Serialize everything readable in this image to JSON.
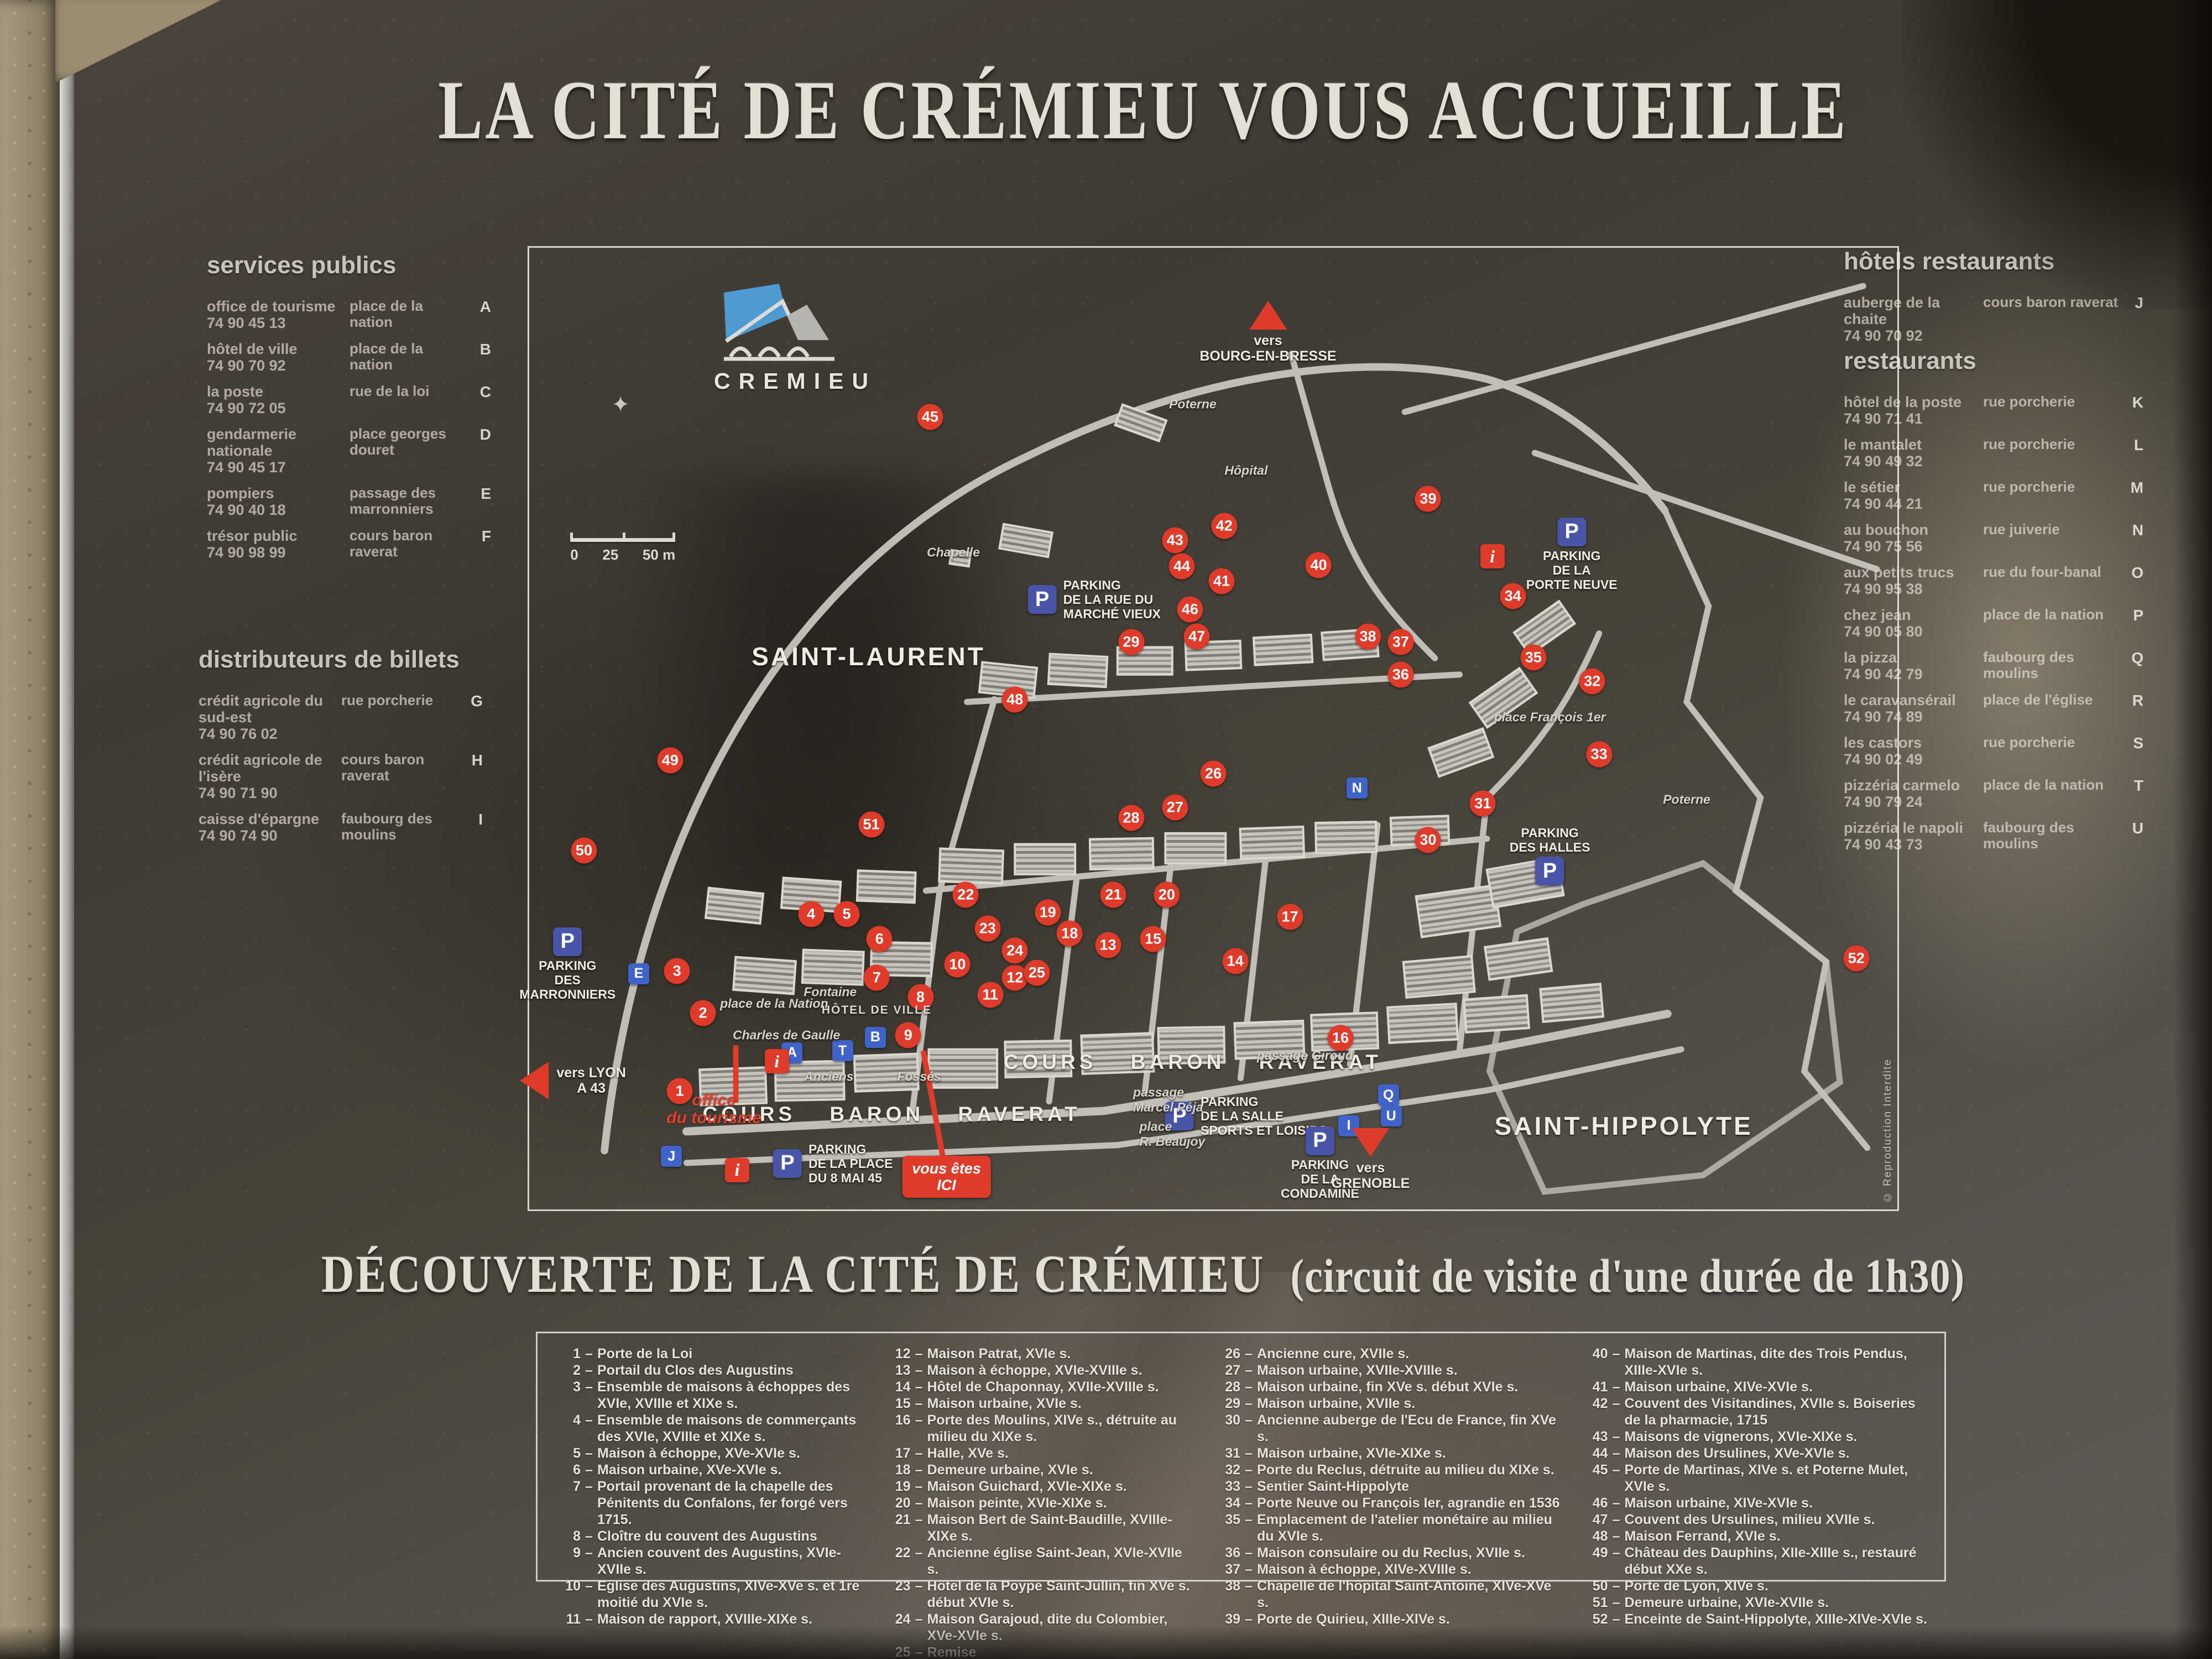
{
  "board": {
    "title": "LA CITÉ DE CRÉMIEU VOUS ACCUEILLE",
    "colors": {
      "accent_red": "#df3b2a",
      "parking_blue": "#4a55a8",
      "letter_blue": "#3f63c8",
      "logo_blue": "#4e9bd4"
    }
  },
  "services_publics": {
    "heading": "services publics",
    "entries": [
      {
        "name": "office de tourisme",
        "phone": "74 90 45 13",
        "location": "place de la nation",
        "letter": "A"
      },
      {
        "name": "hôtel de ville",
        "phone": "74 90 70 92",
        "location": "place de la nation",
        "letter": "B"
      },
      {
        "name": "la poste",
        "phone": "74 90 72 05",
        "location": "rue de la loi",
        "letter": "C"
      },
      {
        "name": "gendarmerie nationale",
        "phone": "74 90 45 17",
        "location": "place georges douret",
        "letter": "D"
      },
      {
        "name": "pompiers",
        "phone": "74 90 40 18",
        "location": "passage des marronniers",
        "letter": "E"
      },
      {
        "name": "trésor public",
        "phone": "74 90 98 99",
        "location": "cours baron raverat",
        "letter": "F"
      }
    ]
  },
  "distributeurs": {
    "heading": "distributeurs de billets",
    "entries": [
      {
        "name": "crédit agricole du sud-est",
        "phone": "74 90 76 02",
        "location": "rue porcherie",
        "letter": "G"
      },
      {
        "name": "crédit agricole de l'isère",
        "phone": "74 90 71 90",
        "location": "cours baron raverat",
        "letter": "H"
      },
      {
        "name": "caisse d'épargne",
        "phone": "74 90 74 90",
        "location": "faubourg des moulins",
        "letter": "I"
      }
    ]
  },
  "hotels_restaurants": {
    "heading": "hôtels restaurants",
    "entries": [
      {
        "name": "auberge de la chaite",
        "phone": "74 90 70 92",
        "location": "cours baron raverat",
        "letter": "J"
      }
    ]
  },
  "restaurants": {
    "heading": "restaurants",
    "entries": [
      {
        "name": "hôtel de la poste",
        "phone": "74 90 71 41",
        "location": "rue porcherie",
        "letter": "K"
      },
      {
        "name": "le mantalet",
        "phone": "74 90 49 32",
        "location": "rue porcherie",
        "letter": "L"
      },
      {
        "name": "le sétier",
        "phone": "74 90 44 21",
        "location": "rue porcherie",
        "letter": "M"
      },
      {
        "name": "au bouchon",
        "phone": "74 90 75 56",
        "location": "rue juiverie",
        "letter": "N"
      },
      {
        "name": "aux petits trucs",
        "phone": "74 90 95 38",
        "location": "rue du four-banal",
        "letter": "O"
      },
      {
        "name": "chez jean",
        "phone": "74 90 05 80",
        "location": "place de la nation",
        "letter": "P"
      },
      {
        "name": "la pizza",
        "phone": "74 90 42 79",
        "location": "faubourg des moulins",
        "letter": "Q"
      },
      {
        "name": "le caravansérail",
        "phone": "74 90 74 89",
        "location": "place de l'église",
        "letter": "R"
      },
      {
        "name": "les castors",
        "phone": "74 90 02 49",
        "location": "rue porcherie",
        "letter": "S"
      },
      {
        "name": "pizzéria carmelo",
        "phone": "74 90 79 24",
        "location": "place de la nation",
        "letter": "T"
      },
      {
        "name": "pizzéria le napoli",
        "phone": "74 90 43 73",
        "location": "faubourg des moulins",
        "letter": "U"
      }
    ]
  },
  "map": {
    "logo_text": "CREMIEU",
    "copyright": "© Reproduction Interdite",
    "scale_labels": [
      "0",
      "25",
      "50 m"
    ],
    "you_are_here": {
      "text": "vous êtes\nICI",
      "x": 30.5,
      "y": 96.6
    },
    "red_markers": [
      {
        "n": 1,
        "x": 11.0,
        "y": 87.7
      },
      {
        "n": 2,
        "x": 12.7,
        "y": 79.6
      },
      {
        "n": 3,
        "x": 10.8,
        "y": 75.2
      },
      {
        "n": 4,
        "x": 20.6,
        "y": 69.3
      },
      {
        "n": 5,
        "x": 23.2,
        "y": 69.3
      },
      {
        "n": 6,
        "x": 25.6,
        "y": 71.9
      },
      {
        "n": 7,
        "x": 25.4,
        "y": 75.9
      },
      {
        "n": 8,
        "x": 28.6,
        "y": 77.9
      },
      {
        "n": 9,
        "x": 27.7,
        "y": 81.9
      },
      {
        "n": 10,
        "x": 31.3,
        "y": 74.5
      },
      {
        "n": 11,
        "x": 33.7,
        "y": 77.7
      },
      {
        "n": 12,
        "x": 35.5,
        "y": 75.9
      },
      {
        "n": 13,
        "x": 42.3,
        "y": 72.5
      },
      {
        "n": 14,
        "x": 51.6,
        "y": 74.2
      },
      {
        "n": 15,
        "x": 45.6,
        "y": 71.9
      },
      {
        "n": 16,
        "x": 59.3,
        "y": 82.2
      },
      {
        "n": 17,
        "x": 55.6,
        "y": 69.6
      },
      {
        "n": 18,
        "x": 39.5,
        "y": 71.3
      },
      {
        "n": 19,
        "x": 37.9,
        "y": 69.1
      },
      {
        "n": 20,
        "x": 46.6,
        "y": 67.3
      },
      {
        "n": 21,
        "x": 42.7,
        "y": 67.3
      },
      {
        "n": 22,
        "x": 31.9,
        "y": 67.3
      },
      {
        "n": 23,
        "x": 33.5,
        "y": 70.8
      },
      {
        "n": 24,
        "x": 35.5,
        "y": 73.1
      },
      {
        "n": 25,
        "x": 37.1,
        "y": 75.4
      },
      {
        "n": 26,
        "x": 50.0,
        "y": 54.7
      },
      {
        "n": 27,
        "x": 47.2,
        "y": 58.2
      },
      {
        "n": 28,
        "x": 44.0,
        "y": 59.3
      },
      {
        "n": 29,
        "x": 44.0,
        "y": 41.0
      },
      {
        "n": 30,
        "x": 65.7,
        "y": 61.6
      },
      {
        "n": 31,
        "x": 69.7,
        "y": 57.8
      },
      {
        "n": 32,
        "x": 77.7,
        "y": 45.1
      },
      {
        "n": 33,
        "x": 78.2,
        "y": 52.7
      },
      {
        "n": 34,
        "x": 71.9,
        "y": 36.2
      },
      {
        "n": 35,
        "x": 73.4,
        "y": 42.6
      },
      {
        "n": 36,
        "x": 63.7,
        "y": 44.4
      },
      {
        "n": 37,
        "x": 63.7,
        "y": 41.0
      },
      {
        "n": 38,
        "x": 61.3,
        "y": 40.4
      },
      {
        "n": 39,
        "x": 65.7,
        "y": 26.1
      },
      {
        "n": 40,
        "x": 57.7,
        "y": 33.0
      },
      {
        "n": 41,
        "x": 50.6,
        "y": 34.7
      },
      {
        "n": 42,
        "x": 50.8,
        "y": 28.9
      },
      {
        "n": 43,
        "x": 47.2,
        "y": 30.4
      },
      {
        "n": 44,
        "x": 47.7,
        "y": 33.1
      },
      {
        "n": 45,
        "x": 29.3,
        "y": 17.6
      },
      {
        "n": 46,
        "x": 48.3,
        "y": 37.6
      },
      {
        "n": 47,
        "x": 48.8,
        "y": 40.4
      },
      {
        "n": 48,
        "x": 35.5,
        "y": 47.0
      },
      {
        "n": 49,
        "x": 10.3,
        "y": 53.3
      },
      {
        "n": 50,
        "x": 4.0,
        "y": 62.7
      },
      {
        "n": 51,
        "x": 25.0,
        "y": 60.0
      },
      {
        "n": 52,
        "x": 97.0,
        "y": 73.9
      }
    ],
    "letter_markers": [
      {
        "l": "A",
        "x": 19.2,
        "y": 83.7
      },
      {
        "l": "B",
        "x": 25.3,
        "y": 82.1
      },
      {
        "l": "E",
        "x": 8.0,
        "y": 75.5
      },
      {
        "l": "J",
        "x": 10.4,
        "y": 94.5
      },
      {
        "l": "N",
        "x": 60.5,
        "y": 56.2
      },
      {
        "l": "T",
        "x": 22.9,
        "y": 83.5
      },
      {
        "l": "Q",
        "x": 62.8,
        "y": 88.1
      },
      {
        "l": "U",
        "x": 63.0,
        "y": 90.3
      },
      {
        "l": "I",
        "x": 59.9,
        "y": 91.3
      }
    ],
    "info_markers": [
      {
        "x": 18.1,
        "y": 84.6
      },
      {
        "x": 15.2,
        "y": 95.9
      },
      {
        "x": 70.4,
        "y": 32.1
      }
    ],
    "parkings": [
      {
        "x": 2.8,
        "y": 74.5,
        "label": "PARKING\nDES\nMARRONNIERS",
        "lpos": "below"
      },
      {
        "x": 22.2,
        "y": 95.2,
        "label": "PARKING\nDE LA PLACE\nDU 8 MAI 45",
        "lpos": "right"
      },
      {
        "x": 41.3,
        "y": 36.6,
        "label": "PARKING\nDE LA RUE DU\nMARCHÉ VIEUX",
        "lpos": "right"
      },
      {
        "x": 76.2,
        "y": 31.9,
        "label": "PARKING\nDE LA\nPORTE NEUVE",
        "lpos": "below"
      },
      {
        "x": 74.6,
        "y": 63.2,
        "label": "PARKING\nDES HALLES",
        "lpos": "above"
      },
      {
        "x": 52.4,
        "y": 90.3,
        "label": "PARKING\nDE LA SALLE\nSPORTS ET LOISIRS",
        "lpos": "right"
      },
      {
        "x": 57.8,
        "y": 95.2,
        "label": "PARKING\nDE LA\nCONDAMINE",
        "lpos": "below"
      }
    ],
    "directions": [
      {
        "label": "vers\nBOURG-EN-BRESSE",
        "dir": "up",
        "x": 54.0,
        "y": 8.8
      },
      {
        "label": "vers LYON\nA 43",
        "dir": "left",
        "x": 3.2,
        "y": 86.6
      },
      {
        "label": "vers\nGRENOBLE",
        "dir": "down",
        "x": 61.5,
        "y": 94.8
      }
    ],
    "labels": [
      {
        "t": "SAINT-LAURENT",
        "x": 24.8,
        "y": 42.5,
        "s": "area"
      },
      {
        "t": "SAINT-HIPPOLYTE",
        "x": 80.0,
        "y": 91.3,
        "s": "area"
      },
      {
        "t": "COURS BARON RAVERAT",
        "x": 26.5,
        "y": 90.1,
        "s": "cours"
      },
      {
        "t": "COURS BARON RAVERAT",
        "x": 48.5,
        "y": 84.7,
        "s": "cours"
      },
      {
        "t": "Anciens",
        "x": 21.9,
        "y": 86.2,
        "s": "street"
      },
      {
        "t": "Fossés",
        "x": 28.5,
        "y": 86.2,
        "s": "street"
      },
      {
        "t": "place de la Nation",
        "x": 17.9,
        "y": 78.6,
        "s": "street"
      },
      {
        "t": "Charles de Gaulle",
        "x": 18.8,
        "y": 81.9,
        "s": "street"
      },
      {
        "t": "Fontaine",
        "x": 22.0,
        "y": 77.4,
        "s": "street"
      },
      {
        "t": "HÔTEL DE VILLE",
        "x": 25.4,
        "y": 79.3,
        "s": "small"
      },
      {
        "t": "place François 1er",
        "x": 74.6,
        "y": 48.8,
        "s": "street"
      },
      {
        "t": "Poterne",
        "x": 48.5,
        "y": 16.3,
        "s": "street"
      },
      {
        "t": "Poterne",
        "x": 84.6,
        "y": 57.4,
        "s": "street"
      },
      {
        "t": "Chapelle",
        "x": 31.0,
        "y": 31.7,
        "s": "street"
      },
      {
        "t": "Hôpital",
        "x": 52.4,
        "y": 23.2,
        "s": "street"
      },
      {
        "t": "passage Giroud",
        "x": 56.7,
        "y": 84.0,
        "s": "street"
      },
      {
        "t": "passage\nMarcel Péja",
        "x": 46.7,
        "y": 88.6,
        "s": "street"
      },
      {
        "t": "place\nR. Beaujoy",
        "x": 47.0,
        "y": 92.2,
        "s": "street"
      },
      {
        "t": "office\ndu tourisme",
        "x": 13.5,
        "y": 89.6,
        "s": "red"
      }
    ]
  },
  "discovery": {
    "heading_main": "DÉCOUVERTE DE LA CITÉ DE CRÉMIEU",
    "heading_sub": "(circuit de visite d'une durée de 1h30)",
    "columns": [
      [
        {
          "n": 1,
          "t": "Porte de la Loi"
        },
        {
          "n": 2,
          "t": "Portail du Clos des Augustins"
        },
        {
          "n": 3,
          "t": "Ensemble de maisons à échoppes des XVIe, XVIIIe et XIXe s."
        },
        {
          "n": 4,
          "t": "Ensemble de maisons de commerçants des XVIe, XVIIIe et XIXe s."
        },
        {
          "n": 5,
          "t": "Maison à échoppe, XVe-XVIe s."
        },
        {
          "n": 6,
          "t": "Maison urbaine, XVe-XVIe s."
        },
        {
          "n": 7,
          "t": "Portail provenant de la chapelle des Pénitents du Confalons, fer forgé vers 1715."
        },
        {
          "n": 8,
          "t": "Cloître du couvent des Augustins"
        },
        {
          "n": 9,
          "t": "Ancien couvent des Augustins, XVIe-XVIIe s."
        },
        {
          "n": 10,
          "t": "Eglise des Augustins, XIVe-XVe s. et 1re moitié du XVIe s."
        },
        {
          "n": 11,
          "t": "Maison de rapport, XVIIIe-XIXe s."
        }
      ],
      [
        {
          "n": 12,
          "t": "Maison Patrat, XVIe s."
        },
        {
          "n": 13,
          "t": "Maison à échoppe, XVIe-XVIIIe s."
        },
        {
          "n": 14,
          "t": "Hôtel de Chaponnay, XVIIe-XVIIIe s."
        },
        {
          "n": 15,
          "t": "Maison urbaine, XVIe s."
        },
        {
          "n": 16,
          "t": "Porte des Moulins, XIVe s., détruite au milieu du XIXe s."
        },
        {
          "n": 17,
          "t": "Halle, XVe s."
        },
        {
          "n": 18,
          "t": "Demeure urbaine, XVIe s."
        },
        {
          "n": 19,
          "t": "Maison Guichard, XVIe-XIXe s."
        },
        {
          "n": 20,
          "t": "Maison peinte, XVIe-XIXe s."
        },
        {
          "n": 21,
          "t": "Maison Bert de Saint-Baudille, XVIIIe-XIXe s."
        },
        {
          "n": 22,
          "t": "Ancienne église Saint-Jean, XVIe-XVIIe s."
        },
        {
          "n": 23,
          "t": "Hôtel de la Poype Saint-Jullin, fin XVe s. début XVIe s."
        },
        {
          "n": 24,
          "t": "Maison Garajoud, dite du Colombier, XVe-XVIe s."
        },
        {
          "n": 25,
          "t": "Remise"
        }
      ],
      [
        {
          "n": 26,
          "t": "Ancienne cure, XVIIe s."
        },
        {
          "n": 27,
          "t": "Maison urbaine, XVIIe-XVIIIe s."
        },
        {
          "n": 28,
          "t": "Maison urbaine, fin XVe s. début XVIe s."
        },
        {
          "n": 29,
          "t": "Maison urbaine, XVIIe s."
        },
        {
          "n": 30,
          "t": "Ancienne auberge de l'Ecu de France, fin XVe s."
        },
        {
          "n": 31,
          "t": "Maison urbaine, XVIe-XIXe s."
        },
        {
          "n": 32,
          "t": "Porte du Reclus, détruite au milieu du XIXe s."
        },
        {
          "n": 33,
          "t": "Sentier Saint-Hippolyte"
        },
        {
          "n": 34,
          "t": "Porte Neuve ou François Ier, agrandie en 1536"
        },
        {
          "n": 35,
          "t": "Emplacement de l'atelier monétaire au milieu du XVIe s."
        },
        {
          "n": 36,
          "t": "Maison consulaire ou du Reclus, XVIIe s."
        },
        {
          "n": 37,
          "t": "Maison à échoppe, XIVe-XVIIIe s."
        },
        {
          "n": 38,
          "t": "Chapelle de l'hôpital Saint-Antoine, XIVe-XVe s."
        },
        {
          "n": 39,
          "t": "Porte de Quirieu, XIIIe-XIVe s."
        }
      ],
      [
        {
          "n": 40,
          "t": "Maison de Martinas, dite des Trois Pendus, XIIIe-XVIe s."
        },
        {
          "n": 41,
          "t": "Maison urbaine, XIVe-XVIe s."
        },
        {
          "n": 42,
          "t": "Couvent des Visitandines, XVIIe s. Boiseries de la pharmacie, 1715"
        },
        {
          "n": 43,
          "t": "Maisons de vignerons, XVIe-XIXe s."
        },
        {
          "n": 44,
          "t": "Maison des Ursulines, XVe-XVIe s."
        },
        {
          "n": 45,
          "t": "Porte de Martinas, XIVe s. et Poterne Mulet, XVIe s."
        },
        {
          "n": 46,
          "t": "Maison urbaine, XIVe-XVIe s."
        },
        {
          "n": 47,
          "t": "Couvent des Ursulines, milieu XVIIe s."
        },
        {
          "n": 48,
          "t": "Maison Ferrand, XVIe s."
        },
        {
          "n": 49,
          "t": "Château des Dauphins, XIIe-XIIIe s., restauré début XXe s."
        },
        {
          "n": 50,
          "t": "Porte de Lyon, XIVe s."
        },
        {
          "n": 51,
          "t": "Demeure urbaine, XVIe-XVIIe s."
        },
        {
          "n": 52,
          "t": "Enceinte de Saint-Hippolyte, XIIIe-XIVe-XVIe s."
        }
      ]
    ]
  }
}
